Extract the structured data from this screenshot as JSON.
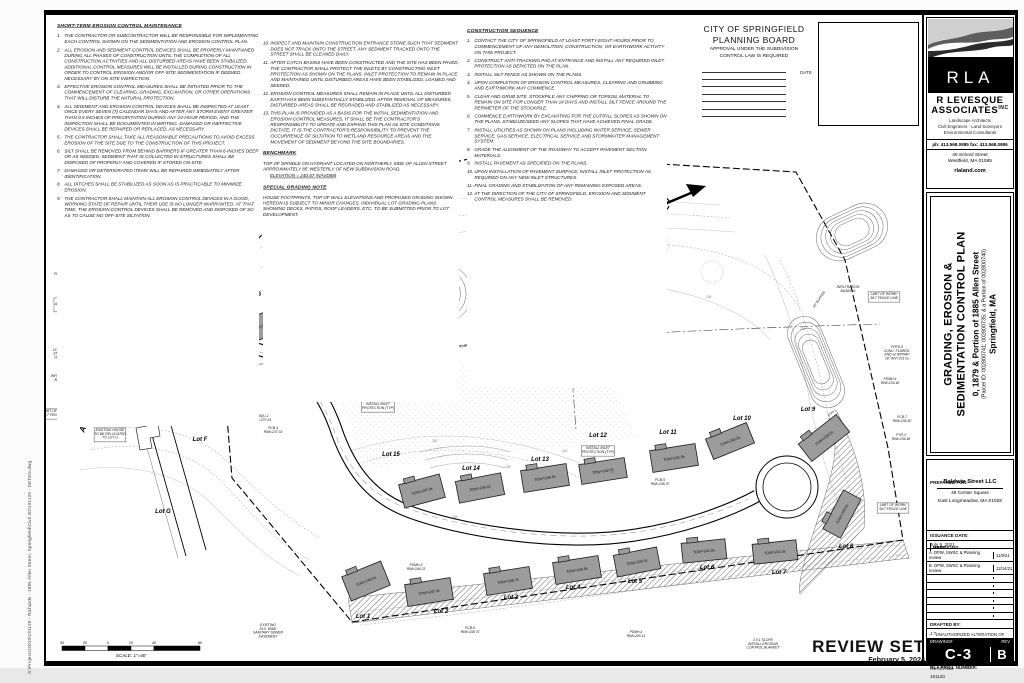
{
  "edge_note": "S:\\Projects\\2019\\191120 - Richards - 1885 Allen Street, Springfield\\Civil 3D\\191120 - DETEN.dwg",
  "notes_maintenance": {
    "title": "SHORT-TERM EROSION CONTROL MAINTENANCE",
    "items": [
      {
        "n": "1.",
        "t": "THE CONTRACTOR OR SUBCONTRACTOR WILL BE RESPONSIBLE FOR IMPLEMENTING EACH CONTROL SHOWN ON THE SEDIMENTATION AND EROSION CONTROL PLAN."
      },
      {
        "n": "2.",
        "t": "ALL EROSION AND SEDIMENT CONTROL DEVICES SHALL BE PROPERLY MAINTAINED DURING ALL PHASES OF CONSTRUCTION UNTIL THE COMPLETION OF ALL CONSTRUCTION ACTIVITIES AND ALL DISTURBED AREAS HAVE BEEN STABILIZED. ADDITIONAL CONTROL MEASURES WILL BE INSTALLED DURING CONSTRUCTION IN ORDER TO CONTROL EROSION AND/OR OFF-SITE SEDIMENTATION IF DEEMED NECESSARY BY ON-SITE INSPECTION."
      },
      {
        "n": "3.",
        "t": "EFFECTIVE EROSION CONTROL MEASURES SHALL BE INITIATED PRIOR TO THE COMMENCEMENT OF CLEARING, GRADING, EXCAVATION, OR OTHER OPERATIONS THAT WILL DISTURB THE NATURAL PROTECTION."
      },
      {
        "n": "4.",
        "t": "ALL SEDIMENT AND EROSION CONTROL DEVICES SHALL BE INSPECTED AT LEAST ONCE EVERY SEVEN (7) CALENDAR DAYS AND AFTER ANY STORM EVENT GREATER THAN 0.5 INCHES OF PRECIPITATION DURING ANY 24-HOUR PERIOD, AND THE INSPECTION SHALL BE DOCUMENTED IN WRITING. DAMAGED OR INEFFECTIVE DEVICES SHALL BE REPAIRED OR REPLACED, AS NECESSARY."
      },
      {
        "n": "5.",
        "t": "THE CONTRACTOR SHALL TAKE ALL REASONABLE PRECAUTIONS TO AVOID EXCESS EROSION OF THE SITE DUE TO THE CONSTRUCTION OF THIS PROJECT."
      },
      {
        "n": "6.",
        "t": "SILT SHALL BE REMOVED FROM BEHIND BARRIERS IF GREATER THAN 6-INCHES DEEP OR AS NEEDED. SEDIMENT THAT IS COLLECTED IN STRUCTURES SHALL BE DISPOSED OF PROPERLY AND COVERED IF STORED ON-SITE."
      },
      {
        "n": "7.",
        "t": "DAMAGED OR DETERIORATED ITEMS WILL BE REPAIRED IMMEDIATELY AFTER IDENTIFICATION."
      },
      {
        "n": "8.",
        "t": "ALL DITCHES SHALL BE STABILIZED AS SOON AS IS PRACTICABLE TO MINIMIZE EROSION."
      },
      {
        "n": "9.",
        "t": "THE CONTRACTOR SHALL MAINTAIN ALL EROSION CONTROL DEVICES IN A GOOD, WORKING STATE OF REPAIR UNTIL THEIR USE IS NO LONGER WARRANTED. AT THAT TIME, THE EROSION CONTROL DEVICES SHALL BE REMOVED AND DISPOSED OF SO AS TO CAUSE NO OFF-SITE SILTATION."
      }
    ]
  },
  "notes_continued": {
    "items": [
      {
        "n": "10.",
        "t": "INSPECT AND MAINTAIN CONSTRUCTION ENTRANCE STONE SUCH THAT SEDIMENT DOES NOT TRACK ONTO THE STREET. ANY SEDIMENT TRACKED ONTO THE STREET SHALL BE CLEANED DAILY."
      },
      {
        "n": "11.",
        "t": "AFTER CATCH BASINS HAVE BEEN CONSTRUCTED AND THE SITE HAS BEEN PAVED, THE CONTRACTOR SHALL PROTECT THE INLETS BY CONSTRUCTING INLET PROTECTION AS SHOWN ON THE PLANS. INLET PROTECTION TO REMAIN IN PLACE AND MAINTAINED UNTIL DISTURBED AREAS HAVE BEEN STABILIZED, LOAMED AND SEEDED."
      },
      {
        "n": "12.",
        "t": "EROSION CONTROL MEASURES SHALL REMAIN IN PLACE UNTIL ALL DISTURBED EARTH HAS BEEN SUBSTANTIALLY STABILIZED. AFTER REMOVAL OF MEASURES, DISTURBED AREAS SHALL BE REGRADED AND STABILIZED AS NECESSARY."
      },
      {
        "n": "13.",
        "t": "THIS PLAN IS PROVIDED AS A BASIS FOR THE INITIAL SEDIMENTATION AND EROSION CONTROL MEASURES. IT SHALL BE THE CONTRACTOR'S RESPONSIBILITY TO UPDATE AND EXPAND THIS PLAN AS SITE CONDITIONS DICTATE. IT IS THE CONTRACTOR'S RESPONSIBILITY TO PREVENT THE OCCURRENCE OF SILTATION TO WETLAND RESOURCE AREAS AND THE MOVEMENT OF SEDIMENT BEYOND THE SITE BOUNDARIES."
      }
    ]
  },
  "benchmark": {
    "title": "BENCHMARK",
    "body": "TOP OF SPINDLE ON HYDRANT LOCATED ON NORTHERLY SIDE OF ALLEN STREET APPROXIMATELY 85' WESTERLY OF NEW SUBDIVISION ROAD.",
    "elevation": "ELEVATION = 240.67 (NAVD88)"
  },
  "special_grading": {
    "title": "SPECIAL GRADING NOTE",
    "body": "HOUSE FOOTPRINTS, TOP OF WALL ELEVATIONS AND PROPOSED GRADING SHOWN HEREON IS SUBJECT TO MINOR CHANGES. INDIVIDUAL LOT GRADING PLANS SHOWING DECKS, PATIOS, ROOF LEADERS, ETC. TO BE SUBMITTED PRIOR TO LOT DEVELOPMENT."
  },
  "construction_sequence": {
    "title": "CONSTRUCTION SEQUENCE",
    "items": [
      {
        "n": "1.",
        "t": "CONTACT THE CITY OF SPRINGFIELD AT LEAST FORTY-EIGHT HOURS PRIOR TO COMMENCEMENT OF ANY DEMOLITION, CONSTRUCTION, OR EARTHWORK ACTIVITY ON THIS PROJECT."
      },
      {
        "n": "2.",
        "t": "CONSTRUCT ANTI-TRACKING PAD AT ENTRANCE AND INSTALL ANY REQUIRED INLET PROTECTION AS DEPICTED ON THE PLAN."
      },
      {
        "n": "3.",
        "t": "INSTALL SILT FENCE AS SHOWN ON THE PLANS."
      },
      {
        "n": "4.",
        "t": "UPON COMPLETION OF EROSION CONTROL MEASURES, CLEARING AND GRUBBING AND EARTHWORK MAY COMMENCE."
      },
      {
        "n": "5.",
        "t": "CLEAR AND GRUB SITE. STOCKPILE ANY CHIPPING OR TOPSOIL MATERIAL TO REMAIN ON SITE FOR LONGER THAN 14 DAYS AND INSTALL SILT FENCE AROUND THE PERIMETER OF THE STOCKPILE."
      },
      {
        "n": "6.",
        "t": "COMMENCE EARTHWORK BY EXCAVATING FOR THE CUT/FILL SLOPES AS SHOWN ON THE PLANS. STABILIZE/SEED ANY SLOPES THAT HAVE ACHIEVED FINAL GRADE."
      },
      {
        "n": "7.",
        "t": "INSTALL UTILITIES AS SHOWN ON PLANS INCLUDING WATER SERVICE, SEWER SERVICE, GAS SERVICE, ELECTRICAL SERVICE AND STORMWATER MANAGEMENT SYSTEM."
      },
      {
        "n": "8.",
        "t": "GRADE THE ALIGNMENT OF THE ROADWAY TO ACCEPT PAVEMENT SECTION MATERIALS."
      },
      {
        "n": "9.",
        "t": "INSTALL PAVEMENT AS SPECIFIED ON THE PLANS."
      },
      {
        "n": "10.",
        "t": "UPON INSTALLATION OF PAVEMENT SURFACE, INSTALL INLET PROTECTION AS REQUIRED ON ANY NEW INLET STRUCTURES."
      },
      {
        "n": "11.",
        "t": "FINAL GRADING AND STABILIZATION OF ANY REMAINING EXPOSED AREAS."
      },
      {
        "n": "12.",
        "t": "AT THE DIRECTION OF THE CITY OF SPRINGFIELD, EROSION AND SEDIMENT CONTROL MEASURES SHALL BE REMOVED."
      }
    ]
  },
  "planning_board": {
    "line1": "CITY OF SPRINGFIELD",
    "line2": "PLANNING BOARD",
    "sub1": "APPROVAL UNDER THE SUBDIVISION",
    "sub2": "CONTROL LAW IS REQUIRED",
    "date_label": "DATE"
  },
  "firm": {
    "logo_text": "R L A",
    "name1": "R LEVESQUE",
    "name2": "ASSOCIATES",
    "inc": "INC",
    "svc1": "Landscape Architects",
    "svc2": "Civil Engineers · Land Surveyors",
    "svc3": "Environmental Consultants",
    "phone": "ph: 413.568.0985  fax: 413.568.0986",
    "addr1": "40 School Street",
    "addr2": "Westfield, MA 01085",
    "web": "rlaland.com"
  },
  "project": {
    "title1": "GRADING, EROSION &",
    "title2": "SEDIMENTATION CONTROL PLAN",
    "address": "0, 1879 & Portion of 1885 Allen Street",
    "parcel": "(Parcel ID: 002800741; 002800735; & a Portion of 002800740)",
    "city": "Springfield, MA"
  },
  "prepared_for": {
    "label": "PREPARED FOR:",
    "client": "Baldwin Street LLC",
    "address1": "46 Center Square",
    "address2": "East Longmeadow, MA 01028"
  },
  "issuance": {
    "label": "ISSUANCE DATE:",
    "value": "July 9, 2021"
  },
  "revisions": {
    "header_rev": "REVISIONS:",
    "header_date": "DATE:",
    "rows": [
      {
        "label": "A. DPW, SWSC & Planning review",
        "date": "11/9/21"
      },
      {
        "label": "B. DPW, SWSC & Planning review",
        "date": "12/14/21"
      }
    ],
    "empty_rows": 6
  },
  "drafted": {
    "label": "DRAFTED BY:",
    "value": "J.T."
  },
  "legal": "UNAUTHORIZED ALTERATION OF THIS DOCUMENT IS A VIOLATION OF MASSACHUSETTS STATE LAW",
  "scale_note": {
    "label": "SCALE:",
    "value": "AS NOTED"
  },
  "proj_no": {
    "label": "RLA PROJ. NUMBER:",
    "value": "191120"
  },
  "drawing": {
    "label": "DRAWING#",
    "number": "C-3",
    "rev_label": "REV",
    "rev": "B"
  },
  "review_set": {
    "label": "REVIEW SET",
    "date": "February 5, 2024"
  },
  "scale_bar": {
    "labels": [
      "40",
      "20",
      "0",
      "20",
      "40",
      "80"
    ],
    "caption": "SCALE: 1\"=40'"
  },
  "plan": {
    "street_name": "ALLEN STREET",
    "lots": [
      {
        "label": "Lot 1",
        "tow": "TOW=245.5±",
        "hx": 366,
        "hy": 581,
        "hw": 42,
        "hh": 26,
        "rot": -22,
        "lx": 363,
        "ly": 618
      },
      {
        "label": "Lot 2",
        "tow": "TOW=247.0±",
        "hx": 429,
        "hy": 592,
        "hw": 46,
        "hh": 22,
        "rot": -9,
        "lx": 441,
        "ly": 613
      },
      {
        "label": "Lot 3",
        "tow": "TOW=246.7±",
        "hx": 508,
        "hy": 581,
        "hw": 46,
        "hh": 22,
        "rot": -9,
        "lx": 511,
        "ly": 599
      },
      {
        "label": "Lot 4",
        "tow": "TOW=244.5±",
        "hx": 577,
        "hy": 570,
        "hw": 46,
        "hh": 22,
        "rot": -9,
        "lx": 573,
        "ly": 589
      },
      {
        "label": "Lot 5",
        "tow": "TOW=243.0±",
        "hx": 637,
        "hy": 562,
        "hw": 44,
        "hh": 22,
        "rot": -11,
        "lx": 635,
        "ly": 583
      },
      {
        "label": "Lot 6",
        "tow": "TOW=241.5±",
        "hx": 704,
        "hy": 551,
        "hw": 44,
        "hh": 20,
        "rot": -6,
        "lx": 707,
        "ly": 569
      },
      {
        "label": "Lot 7",
        "tow": "TOW=241.5±",
        "hx": 775,
        "hy": 552,
        "hw": 44,
        "hh": 20,
        "rot": -6,
        "lx": 779,
        "ly": 574
      },
      {
        "label": "Lot 8",
        "tow": "TOW=239.5±",
        "hx": 842,
        "hy": 514,
        "hw": 44,
        "hh": 20,
        "rot": -62,
        "lx": 846,
        "ly": 548
      },
      {
        "label": "Lot 9",
        "tow": "TOW=239.5±",
        "hx": 824,
        "hy": 438,
        "hw": 48,
        "hh": 22,
        "rot": -38,
        "lx": 808,
        "ly": 411
      },
      {
        "label": "Lot 10",
        "tow": "TOW=240.5±",
        "hx": 730,
        "hy": 441,
        "hw": 44,
        "hh": 22,
        "rot": -22,
        "lx": 742,
        "ly": 420
      },
      {
        "label": "Lot 11",
        "tow": "TOW=241.5±",
        "hx": 674,
        "hy": 458,
        "hw": 46,
        "hh": 22,
        "rot": -9,
        "lx": 668,
        "ly": 434
      },
      {
        "label": "Lot 12",
        "tow": "TOW=242.5±",
        "hx": 603,
        "hy": 471,
        "hw": 46,
        "hh": 20,
        "rot": -9,
        "lx": 598,
        "ly": 437
      },
      {
        "label": "Lot 13",
        "tow": "TOW=244.5±",
        "hx": 545,
        "hy": 478,
        "hw": 46,
        "hh": 22,
        "rot": -9,
        "lx": 540,
        "ly": 461
      },
      {
        "label": "Lot 14",
        "tow": "TOW=246.0±",
        "hx": 480,
        "hy": 488,
        "hw": 46,
        "hh": 22,
        "rot": -11,
        "lx": 471,
        "ly": 470
      },
      {
        "label": "Lot 15",
        "tow": "TOW=247.0±",
        "hx": 422,
        "hy": 491,
        "hw": 42,
        "hh": 24,
        "rot": -15,
        "lx": 391,
        "ly": 456
      },
      {
        "label": "Lot 16",
        "tow": "TOW=240.5±",
        "hx": 262,
        "hy": 326,
        "hw": 48,
        "hh": 24,
        "rot": -21,
        "lx": 252,
        "ly": 296
      },
      {
        "label": "Lot 17",
        "tow": "TOW=240.5±",
        "hx": 206,
        "hy": 307,
        "hw": 48,
        "hh": 24,
        "rot": -21,
        "lx": 215,
        "ly": 287
      },
      {
        "label": "Lot F",
        "lx": 200,
        "ly": 441
      },
      {
        "label": "Lot G",
        "lx": 163,
        "ly": 513
      }
    ],
    "basins": [
      {
        "x": 160,
        "y": 376,
        "w": 100,
        "h": 42,
        "rot": -14,
        "rings": 7
      },
      {
        "x": 428,
        "y": 296,
        "w": 88,
        "h": 58,
        "rot": -10,
        "rings": 5
      },
      {
        "x": 852,
        "y": 232,
        "w": 74,
        "h": 46,
        "rot": -25,
        "rings": 5
      },
      {
        "x": 816,
        "y": 362,
        "w": 96,
        "h": 34,
        "rot": 68,
        "rings": 5
      }
    ],
    "callouts": [
      {
        "t": "TYPICAL HOUSE\n(BUILDING SIZE, SHAPE,\nLOCATION & LOT GRADING\nARE APPROXIMATE)",
        "x": 230,
        "y": 200,
        "boxed": true
      },
      {
        "t": "EXTENDED DRY\nDETENTION BASIN",
        "x": 330,
        "y": 211
      },
      {
        "t": "LIMIT OF WORK/\nSILT FENCE LINE",
        "x": 392,
        "y": 210,
        "boxed": true
      },
      {
        "t": "PYD-1\nRIM=235.90",
        "x": 310,
        "y": 224
      },
      {
        "t": "PFES-2\nRIM=236.00",
        "x": 428,
        "y": 227
      },
      {
        "t": "PFES-3\nCONC. FLARED-\nEND w/ RIPRAP\n15\" INV=233.2±",
        "x": 284,
        "y": 246
      },
      {
        "t": "PROPOSED\nGRASS SWALE",
        "x": 232,
        "y": 241
      },
      {
        "t": "EXISTING\nVEGETATION TO\nBE CLEARED",
        "x": 167,
        "y": 248,
        "boxed": true
      },
      {
        "t": "BENCH MARK\nTOP SPINDLE\nHYDRANT\nELEV. 240.67",
        "x": 78,
        "y": 250,
        "boxed": true
      },
      {
        "t": "INSTALL INLET\nPROTECTION (TYP)",
        "x": 70,
        "y": 271
      },
      {
        "t": "PWQU-1\nRIM=237.25",
        "x": 68,
        "y": 288
      },
      {
        "t": "INSTALL\nANTI-TRACKING\nAPRON",
        "x": 68,
        "y": 301,
        "boxed": true
      },
      {
        "t": "PFES-1\nCONC. FLARED-\nEND w/ RIPRAP\n15\" INV=236.04",
        "x": 66,
        "y": 347
      },
      {
        "t": "INFILTRATION\nBASIN #1",
        "x": 62,
        "y": 377
      },
      {
        "t": "LIMIT OF WORK/\nSILT FENCE LINE",
        "x": 56,
        "y": 412,
        "boxed": true
      },
      {
        "t": "EXISTING HOUSE\nTO BE RELOCATED\nTO LOT G",
        "x": 110,
        "y": 431,
        "boxed": true
      },
      {
        "t": "PCB-2\nRIM=237.03",
        "x": 130,
        "y": 402
      },
      {
        "t": "POCS-1\nRIM=236.00",
        "x": 173,
        "y": 420
      },
      {
        "t": "PSMH-1\nRIM=237.64",
        "x": 228,
        "y": 362
      },
      {
        "t": "PSMH-2\nRIM=237.69",
        "x": 244,
        "y": 406
      },
      {
        "t": "PWQU-2\nRIM=237.61",
        "x": 262,
        "y": 417
      },
      {
        "t": "PCB-4\nRIM=237.33",
        "x": 273,
        "y": 429
      },
      {
        "t": "POCS-2\nRIM=236.00",
        "x": 440,
        "y": 236
      },
      {
        "t": "PFES-4\nCONC. FLARED-\nEND w/ RIPRAP\n12\" INV=232.5±",
        "x": 512,
        "y": 251
      },
      {
        "t": "EXISTING\nCITY OF SPRINGFIELD\n25' WIDE SANITARY\nSEWER EASEMENT",
        "x": 576,
        "y": 221
      },
      {
        "t": "8\" INV=231.0\nw/ RIPRAP",
        "x": 614,
        "y": 307
      },
      {
        "t": "EXISTING 25' SANITARY SEWER EASEMENT",
        "x": 436,
        "y": 349,
        "rot": -4
      },
      {
        "t": "PSMH-6\nRIM=237.50",
        "x": 352,
        "y": 374
      },
      {
        "t": "PCB-3\nRIM=237.33",
        "x": 352,
        "y": 388
      },
      {
        "t": "INSTALL INLET\nPROTECTION (TYP)",
        "x": 378,
        "y": 405,
        "boxed": true
      },
      {
        "t": "INSTALL INLET\nPROTECTION (TYP)",
        "x": 598,
        "y": 449,
        "boxed": true
      },
      {
        "t": "PCB-5\nRIM=238.70",
        "x": 660,
        "y": 481
      },
      {
        "t": "PSMH-3\nRIM=244.23",
        "x": 416,
        "y": 566
      },
      {
        "t": "PCB-6\nRIM=238.73",
        "x": 470,
        "y": 629
      },
      {
        "t": "EXISTING\n25.0' WIDE\nSANITARY SEWER\nEASEMENT",
        "x": 268,
        "y": 626
      },
      {
        "t": "PSMH-4\nRIM=240.14",
        "x": 636,
        "y": 633
      },
      {
        "t": "2.0:1 SLOPE\nINSTALL EROSION\nCONTROL BLANKET",
        "x": 763,
        "y": 641
      },
      {
        "t": "PSMH-4\nRIM=233.48",
        "x": 890,
        "y": 380
      },
      {
        "t": "PCB-7\nRIM=236.50",
        "x": 902,
        "y": 418
      },
      {
        "t": "PYD-3\nRIM=236.48",
        "x": 901,
        "y": 436
      },
      {
        "t": "PFES-5\nCONC. FLARED-\nEND w/ RIPRAP\n18\" INV=231.0±",
        "x": 897,
        "y": 348
      },
      {
        "t": "LIMIT OF WORK/\nSILT FENCE LINE",
        "x": 884,
        "y": 295,
        "boxed": true
      },
      {
        "t": "INFILTRATION\nBASIN #2",
        "x": 848,
        "y": 288
      },
      {
        "t": "50' BUFFER",
        "x": 820,
        "y": 300,
        "rot": -55
      },
      {
        "t": "EXT.\nRET.WALL",
        "x": 406,
        "y": 231
      },
      {
        "t": "LIMIT OF WORK/\nSILT FENCE LINE",
        "x": 893,
        "y": 506,
        "boxed": true
      }
    ],
    "contour_labels": [
      {
        "t": "240",
        "x": 432,
        "y": 442
      },
      {
        "t": "238",
        "x": 505,
        "y": 468
      },
      {
        "t": "242",
        "x": 562,
        "y": 452
      },
      {
        "t": "244",
        "x": 610,
        "y": 473
      },
      {
        "t": "236",
        "x": 706,
        "y": 298
      },
      {
        "t": "246",
        "x": 452,
        "y": 518
      },
      {
        "t": "234",
        "x": 800,
        "y": 330
      }
    ]
  },
  "colors": {
    "house_fill": "#9c9c9c",
    "contour": "#c6c6c6",
    "ink": "#000000"
  }
}
